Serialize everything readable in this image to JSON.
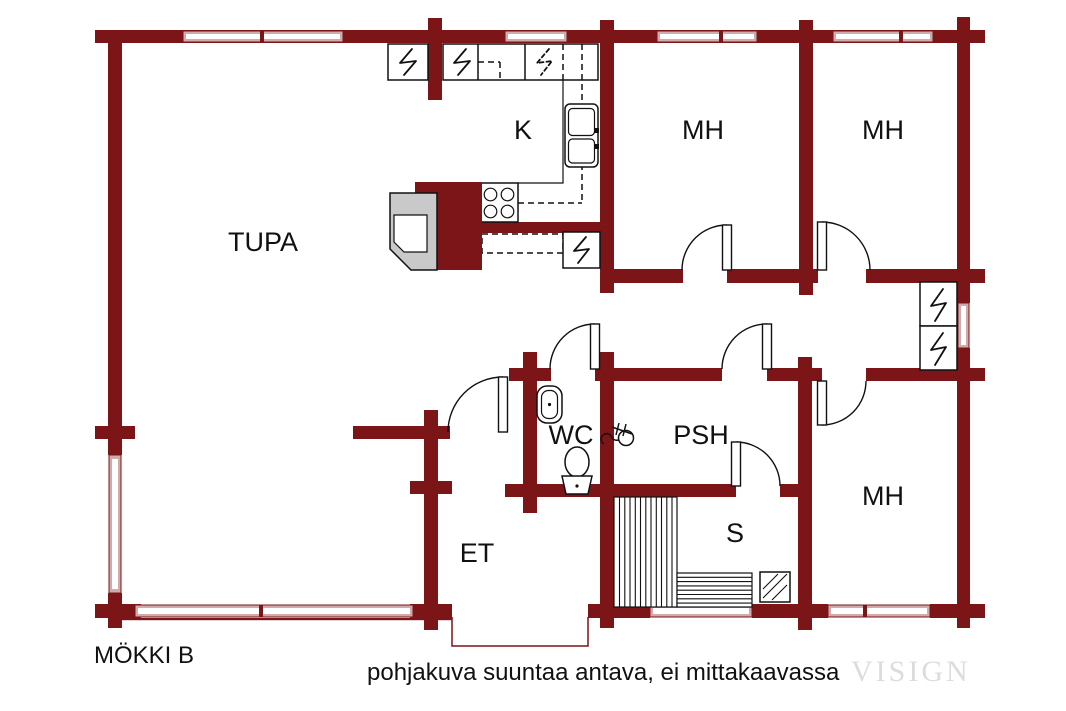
{
  "header": {
    "plan_title": "MÖKKI B"
  },
  "footer": {
    "caption": "pohjakuva suuntaa antava, ei mittakaavassa",
    "watermark": "VISIGN"
  },
  "rooms": {
    "tupa": "TUPA",
    "kitchen": "K",
    "bedroom1": "MH",
    "bedroom2": "MH",
    "bedroom3": "MH",
    "wc": "WC",
    "washroom": "PSH",
    "sauna": "S",
    "entrance": "ET"
  },
  "colors": {
    "wall": "#7b1517",
    "window": "#d0abab",
    "fixture_gray": "#c9c9c9",
    "text": "#111111",
    "watermark": "#dcdcdc"
  }
}
